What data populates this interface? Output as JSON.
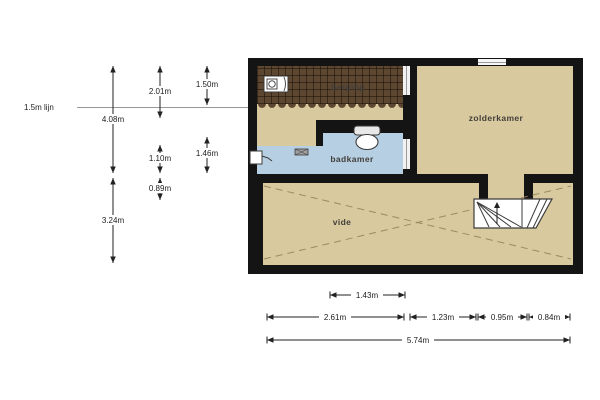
{
  "plan": {
    "rooms": [
      {
        "name": "berging"
      },
      {
        "name": "zolderkamer"
      },
      {
        "name": "badkamer"
      },
      {
        "name": "vide"
      }
    ],
    "fixtures": [
      {
        "icon": "washing-machine-icon"
      },
      {
        "icon": "toilet-icon"
      },
      {
        "icon": "sink-icon"
      },
      {
        "icon": "radiator-icon"
      },
      {
        "icon": "stairs"
      },
      {
        "icon": "stairs-direction-arrow-icon"
      },
      {
        "icon": "window"
      }
    ],
    "colors": {
      "wall": "#141414",
      "floor": "#d8c99e",
      "bathroom_floor": "#b7cfe2",
      "storage_texture": "#5d4730",
      "stairs": "#ffffff"
    }
  },
  "annotations": {
    "reference_line_label": "1.5m lijn",
    "vertical_dims": [
      {
        "label": "4.08m"
      },
      {
        "label": "2.01m"
      },
      {
        "label": "1.50m"
      },
      {
        "label": "1.10m"
      },
      {
        "label": "1.46m"
      },
      {
        "label": "0.89m"
      },
      {
        "label": "3.24m"
      }
    ],
    "horizontal_dims": [
      {
        "label": "1.43m"
      },
      {
        "label": "2.61m"
      },
      {
        "label": "1.23m"
      },
      {
        "label": "0.95m"
      },
      {
        "label": "0.84m"
      },
      {
        "label": "5.74m"
      }
    ]
  }
}
